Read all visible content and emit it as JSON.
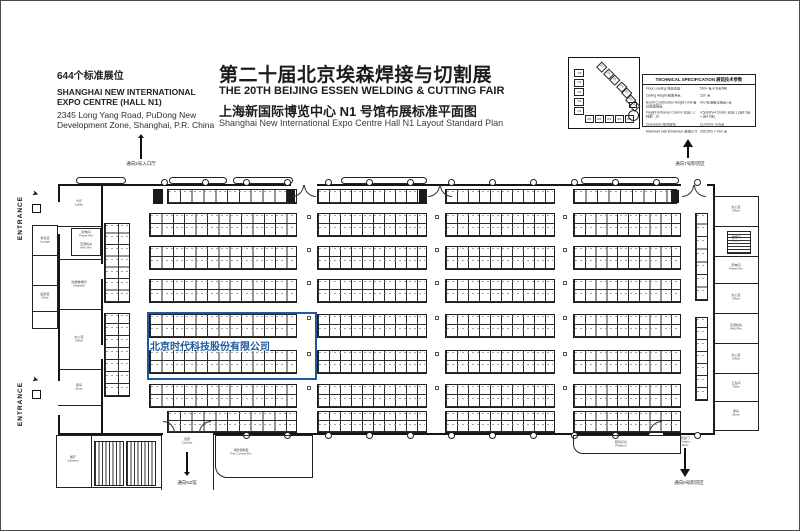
{
  "page": {
    "background": "#ffffff",
    "border_color": "#4a4a4a"
  },
  "header": {
    "booth_count": "644个标准展位",
    "venue_line1": "SHANGHAI NEW INTERNATIONAL",
    "venue_line2": "EXPO CENTRE (HALL N1)",
    "address_line1": "2345 Long Yang Road, PuDong New",
    "address_line2": "Development Zone, Shanghai, P.R. China",
    "title_cn": "第二十届北京埃森焊接与切割展",
    "title_en": "THE 20TH BEIJING ESSEN WELDING & CUTTING FAIR",
    "subtitle_cn": "上海新国际博览中心 N1 号馆布展标准平面图",
    "subtitle_en": "Shanghai New International Expo Centre   Hall N1 Layout Standard Plan",
    "title_color": "#1c1c1c"
  },
  "minimap": {
    "n_halls": [
      "N5",
      "N4",
      "N3",
      "N2",
      "N1"
    ],
    "w_halls": [
      "W5",
      "W4",
      "W3",
      "W2",
      "W1"
    ],
    "e_halls": [
      "E7",
      "E6",
      "E5",
      "E4",
      "E3",
      "E2",
      "E1"
    ]
  },
  "spec_table": {
    "title": "TECHNICAL SPECIFICATION  展馆技术参数",
    "rows": [
      {
        "l": "Floor Loading 地面承重 :",
        "r": "5t/m² 每平方米5吨"
      },
      {
        "l": "Ceiling Height 展馆净高 :",
        "r": "11m 米"
      },
      {
        "l": "Booth Construction Height Limit 展位搭建限高 :",
        "r": "6m (标准展位限高) 米"
      },
      {
        "l": "Freight Entrance Column 货运门 / 柱距 : 10",
        "r": "4.5m(W)×4.5m(H) 货运门 (宽4.5米 × 高4.5米)"
      },
      {
        "l": "Groundnet 地沟网络 :",
        "r": "11,000m² 平方米"
      },
      {
        "l": "Maximum Hall Dimension 展馆尺寸 :",
        "r": "206.25m × 70m 米"
      }
    ]
  },
  "plan": {
    "entrance_label": "ENTRANCE",
    "company": {
      "name": "北京时代科技股份有限公司",
      "color": "#1b5a9e"
    },
    "arrows": {
      "top_left": "通向2号入口厅",
      "top_right": "通向7号卸货区",
      "bottom_center": "通向N2馆",
      "bottom_right": "通向6号卸货区"
    },
    "notes": {
      "corridor": "走廊 Corridor",
      "freight": "货运门 Freight Door"
    },
    "room_labels": [
      {
        "x": 78,
        "y": 199,
        "cn": "大厅",
        "en": "Lobby"
      },
      {
        "x": 85,
        "y": 230,
        "cn": "配电间",
        "en": "Power Rm"
      },
      {
        "x": 85,
        "y": 242,
        "cn": "空调机房",
        "en": "AHU Rm"
      },
      {
        "x": 78,
        "y": 280,
        "cn": "防烟楼梯间",
        "en": "Stairwell"
      },
      {
        "x": 78,
        "y": 335,
        "cn": "办公室",
        "en": "Office"
      },
      {
        "x": 78,
        "y": 383,
        "cn": "库房",
        "en": "Store"
      },
      {
        "x": 44,
        "y": 236,
        "cn": "休息室",
        "en": "Lounge"
      },
      {
        "x": 44,
        "y": 292,
        "cn": "医务室",
        "en": "Clinic"
      },
      {
        "x": 72,
        "y": 455,
        "cn": "餐厅",
        "en": "Canteen"
      },
      {
        "x": 240,
        "y": 448,
        "cn": "消防控制室",
        "en": "Fire Control Rm"
      },
      {
        "x": 620,
        "y": 440,
        "cn": "卸货平台",
        "en": "Platform"
      },
      {
        "x": 735,
        "y": 205,
        "cn": "办公室",
        "en": "Office"
      },
      {
        "x": 735,
        "y": 235,
        "cn": "楼梯间",
        "en": "Stairs"
      },
      {
        "x": 735,
        "y": 263,
        "cn": "配电间",
        "en": "Power Rm"
      },
      {
        "x": 735,
        "y": 293,
        "cn": "办公室",
        "en": "Office"
      },
      {
        "x": 735,
        "y": 323,
        "cn": "空调机房",
        "en": "AHU Rm"
      },
      {
        "x": 735,
        "y": 353,
        "cn": "办公室",
        "en": "Office"
      },
      {
        "x": 735,
        "y": 381,
        "cn": "卫生间",
        "en": "Toilet"
      },
      {
        "x": 735,
        "y": 409,
        "cn": "库房",
        "en": "Store"
      }
    ]
  }
}
